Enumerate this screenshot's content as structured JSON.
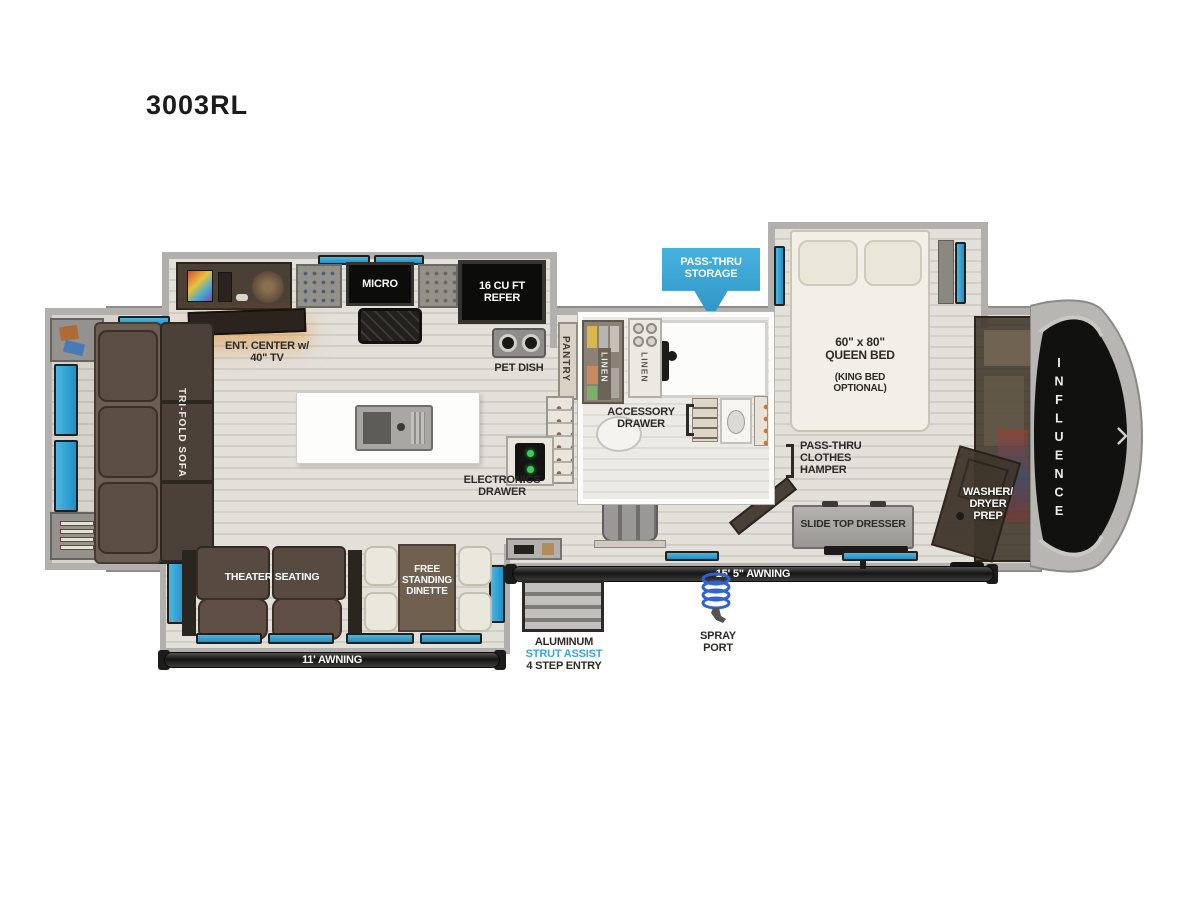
{
  "model": "3003RL",
  "brand": "INFLUENCE",
  "labels": {
    "ent_center": "ENT. CENTER w/\n40\" TV",
    "micro": "MICRO",
    "refer": "16 CU FT\nREFER",
    "pet_dish": "PET DISH",
    "pantry": "PANTRY",
    "linen_left": "LINEN",
    "linen_right": "LINEN",
    "pass_thru_storage": "PASS-THRU\nSTORAGE",
    "queen_bed": "60\" x 80\"\nQUEEN BED",
    "queen_bed_option": "(KING BED\nOPTIONAL)",
    "accessory_drawer": "ACCESSORY\nDRAWER",
    "electronics_drawer": "ELECTRONICS\nDRAWER",
    "tri_fold_sofa": "TRI-FOLD SOFA",
    "theater_seating": "THEATER SEATING",
    "free_standing_dinette": "FREE\nSTANDING\nDINETTE",
    "awning_11": "11' AWNING",
    "awning_15_5": "15' 5\" AWNING",
    "entry_aluminum": "ALUMINUM",
    "entry_strut_assist": "STRUT ASSIST",
    "entry_4_step": "4 STEP ENTRY",
    "spray_port": "SPRAY\nPORT",
    "clothes_hamper": "PASS-THRU\nCLOTHES\nHAMPER",
    "slide_top_dresser": "SLIDE TOP DRESSER",
    "washer_dryer_prep": "WASHER/\nDRYER\nPREP"
  },
  "colors": {
    "window_blue": "#2d9fd6",
    "storage_arrow_blue": "#3aa8d8",
    "strut_assist_blue": "#35a7dc",
    "label_text": "#2b2a27",
    "sofa_brown": "#564a40",
    "appliance_black": "#0c0c0b",
    "wall_gray": "#b1b0ad",
    "floor_tan": "#dedad4",
    "awning_bar": "#1c1c1a"
  }
}
